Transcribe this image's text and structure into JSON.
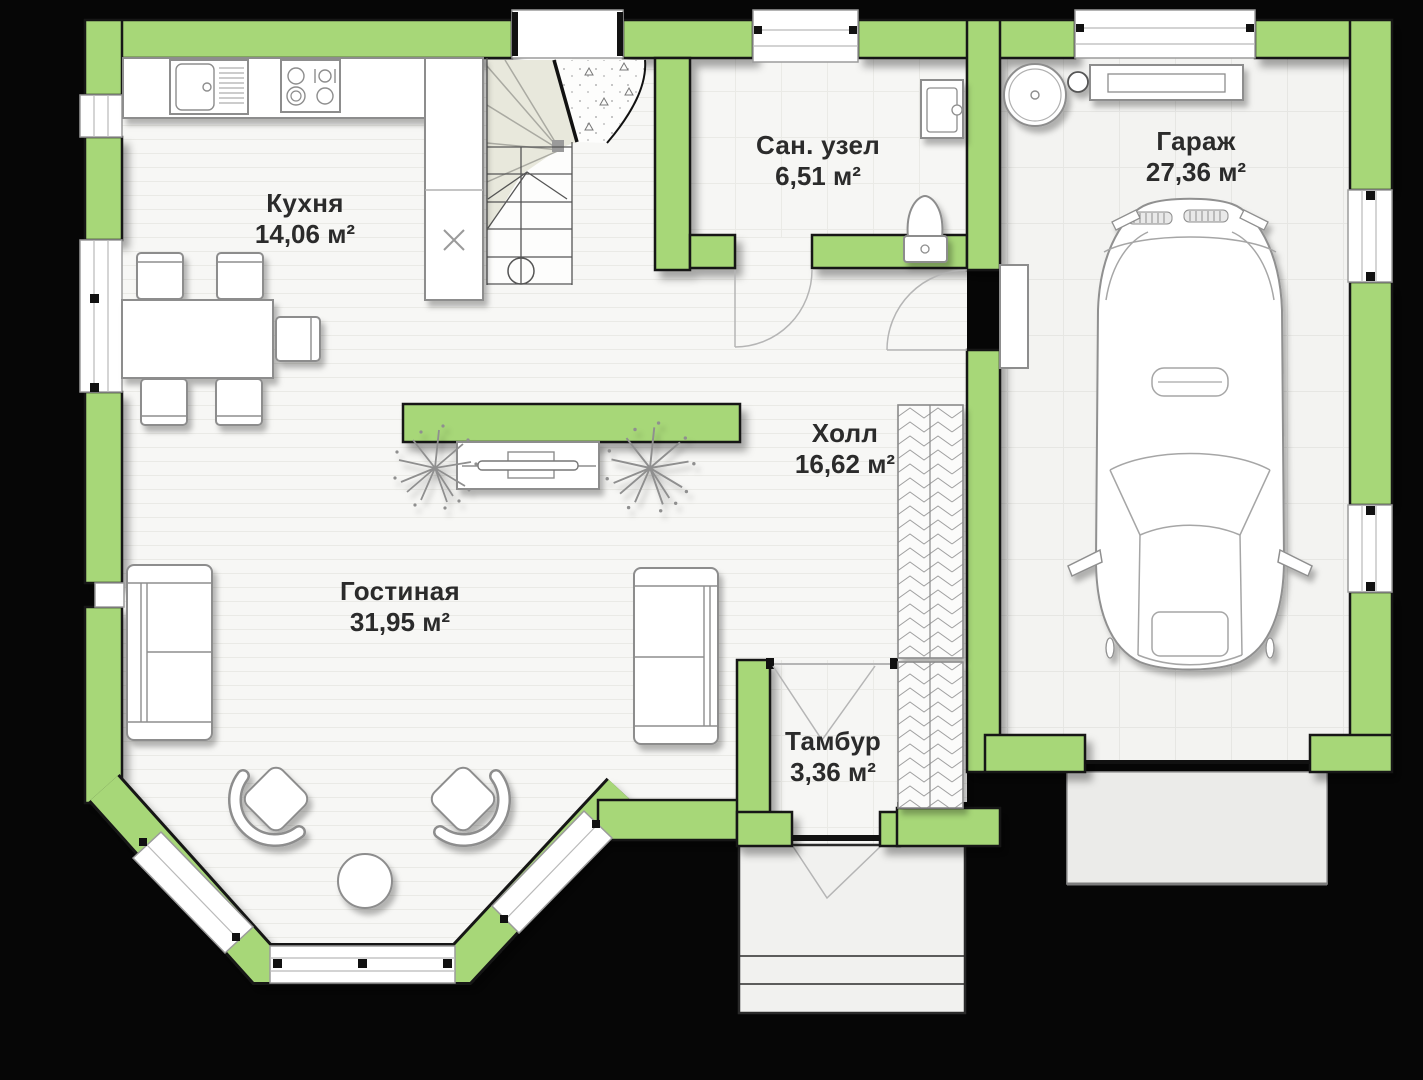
{
  "plan": {
    "colors": {
      "background": "#060606",
      "wall": "#a7d778",
      "wall-outline": "#161616",
      "floor": "#f7f7f5",
      "label": "#2b2b2b"
    },
    "area_unit": "м²",
    "rooms": [
      {
        "id": "kitchen",
        "name": "Кухня",
        "area": "14,06 м²"
      },
      {
        "id": "bathroom",
        "name": "Сан. узел",
        "area": "6,51 м²"
      },
      {
        "id": "garage",
        "name": "Гараж",
        "area": "27,36 м²"
      },
      {
        "id": "hall",
        "name": "Холл",
        "area": "16,62 м²"
      },
      {
        "id": "living",
        "name": "Гостиная",
        "area": "31,95 м²"
      },
      {
        "id": "vestibule",
        "name": "Тамбур",
        "area": "3,36 м²"
      }
    ],
    "objects": [
      "staircase",
      "kitchen-counter",
      "sink-icon",
      "stove-icon",
      "dishwasher-cross-icon",
      "dining-table",
      "chairs",
      "sofa-left",
      "sofa-right",
      "tv-partition",
      "tv-stand",
      "plant-icon",
      "armchairs",
      "coffee-table",
      "wardrobe",
      "toilet-icon",
      "washing-machine-icon",
      "boiler-icon",
      "garage-shelf",
      "car-top-view",
      "porch-steps",
      "driveway-apron",
      "bay-window"
    ]
  }
}
